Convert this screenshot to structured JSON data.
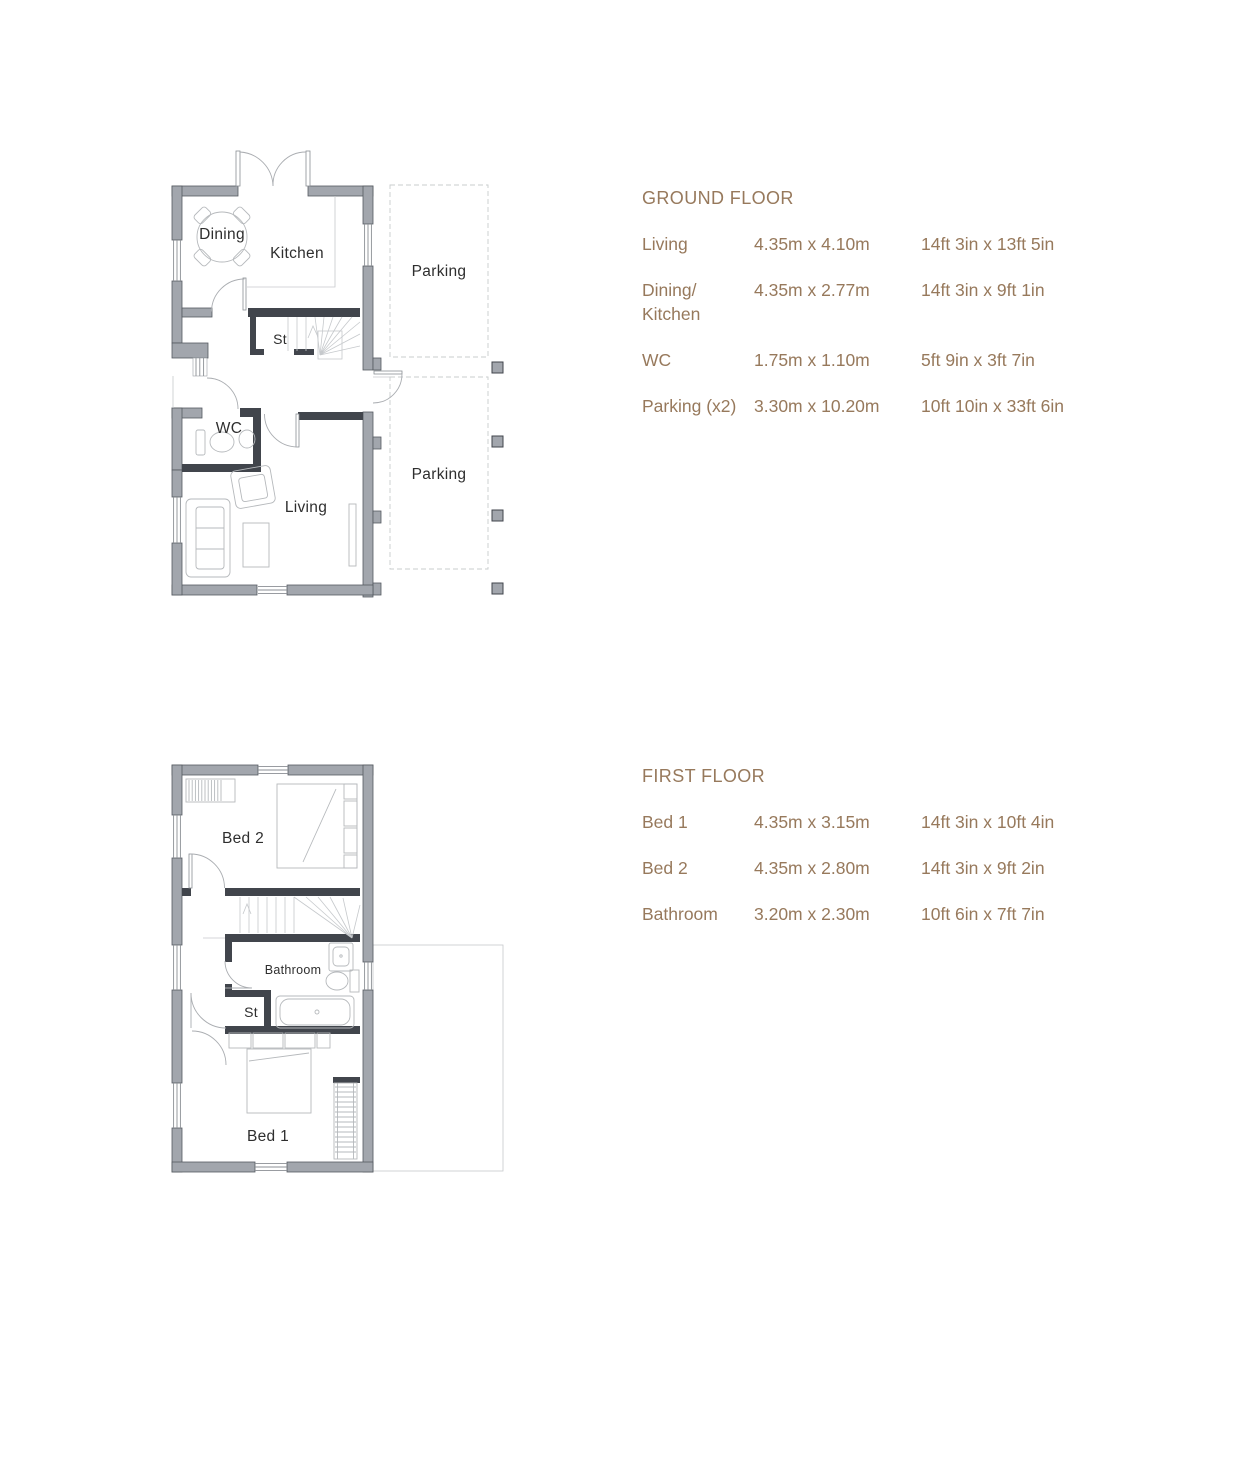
{
  "colors": {
    "wall_gray": "#a2a6ad",
    "wall_dark": "#41454c",
    "line_light": "#b6b9bc",
    "parking_dash": "#c9ccce",
    "table_text_brown": "#97795c",
    "plan_label": "#2e2e2e",
    "background": "#ffffff"
  },
  "ground_floor": {
    "plan": {
      "labels": {
        "dining": "Dining",
        "kitchen": "Kitchen",
        "st": "St",
        "wc": "WC",
        "living": "Living",
        "parking_top": "Parking",
        "parking_bottom": "Parking"
      }
    },
    "table": {
      "title": "GROUND FLOOR",
      "rows": [
        {
          "name": "Living",
          "metric": "4.35m x 4.10m",
          "imperial": "14ft 3in x 13ft 5in"
        },
        {
          "name": "Dining/\nKitchen",
          "metric": "4.35m x 2.77m",
          "imperial": "14ft 3in x 9ft 1in"
        },
        {
          "name": "WC",
          "metric": "1.75m x 1.10m",
          "imperial": "5ft 9in x 3ft 7in"
        },
        {
          "name": "Parking (x2)",
          "metric": "3.30m x 10.20m",
          "imperial": "10ft 10in x 33ft 6in"
        }
      ]
    }
  },
  "first_floor": {
    "plan": {
      "labels": {
        "bed2": "Bed 2",
        "bathroom": "Bathroom",
        "st": "St",
        "bed1": "Bed 1"
      }
    },
    "table": {
      "title": "FIRST FLOOR",
      "rows": [
        {
          "name": "Bed 1",
          "metric": "4.35m x 3.15m",
          "imperial": "14ft 3in x 10ft 4in"
        },
        {
          "name": "Bed 2",
          "metric": "4.35m x 2.80m",
          "imperial": "14ft 3in x 9ft 2in"
        },
        {
          "name": "Bathroom",
          "metric": "3.20m x 2.30m",
          "imperial": "10ft 6in x 7ft 7in"
        }
      ]
    }
  }
}
